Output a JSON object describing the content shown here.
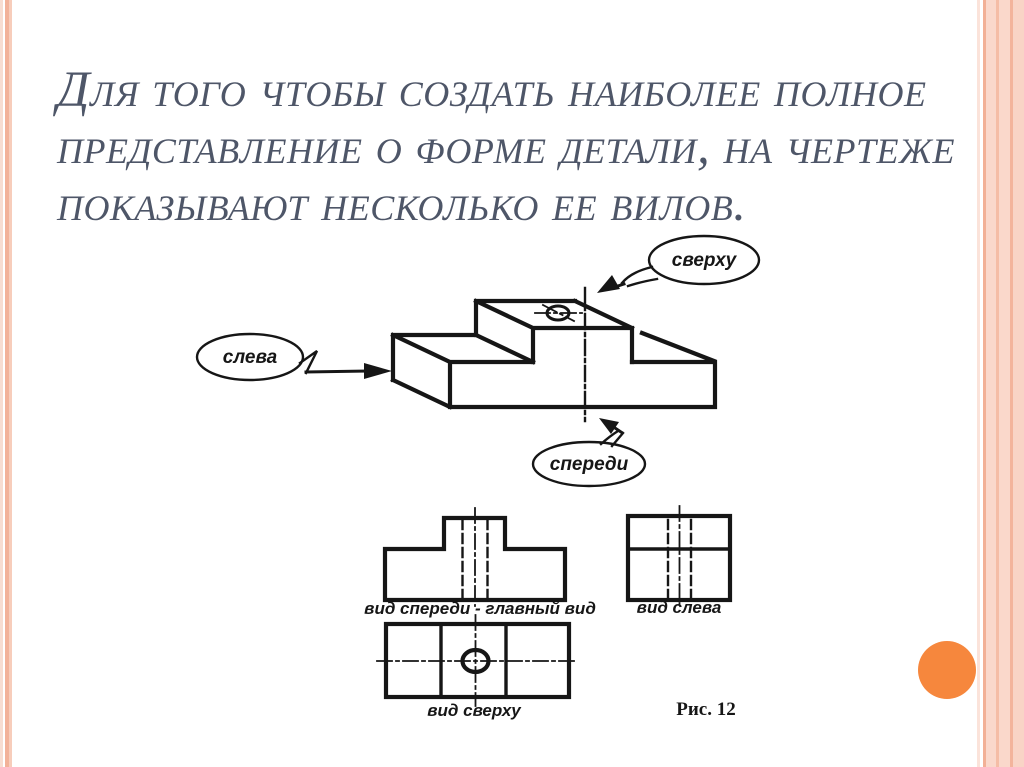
{
  "slide": {
    "title_lines": [
      "Для того чтобы создать наиболее полное",
      "представление о форме детали, на чертеже",
      "показывают несколько ее вилов."
    ],
    "callouts": {
      "top": "сверху",
      "left": "слева",
      "front": "спереди"
    },
    "views": {
      "front": "вид спереди - главный вид",
      "left": "вид слева",
      "top": "вид сверху"
    },
    "caption": "Рис. 12",
    "colors": {
      "background": "#ffffff",
      "title_text": "#4e5668",
      "ink": "#161616",
      "accent_orange": "#f6873d",
      "stripe_salmon": "#f2b299",
      "stripe_light": "#f8d0c1"
    }
  }
}
